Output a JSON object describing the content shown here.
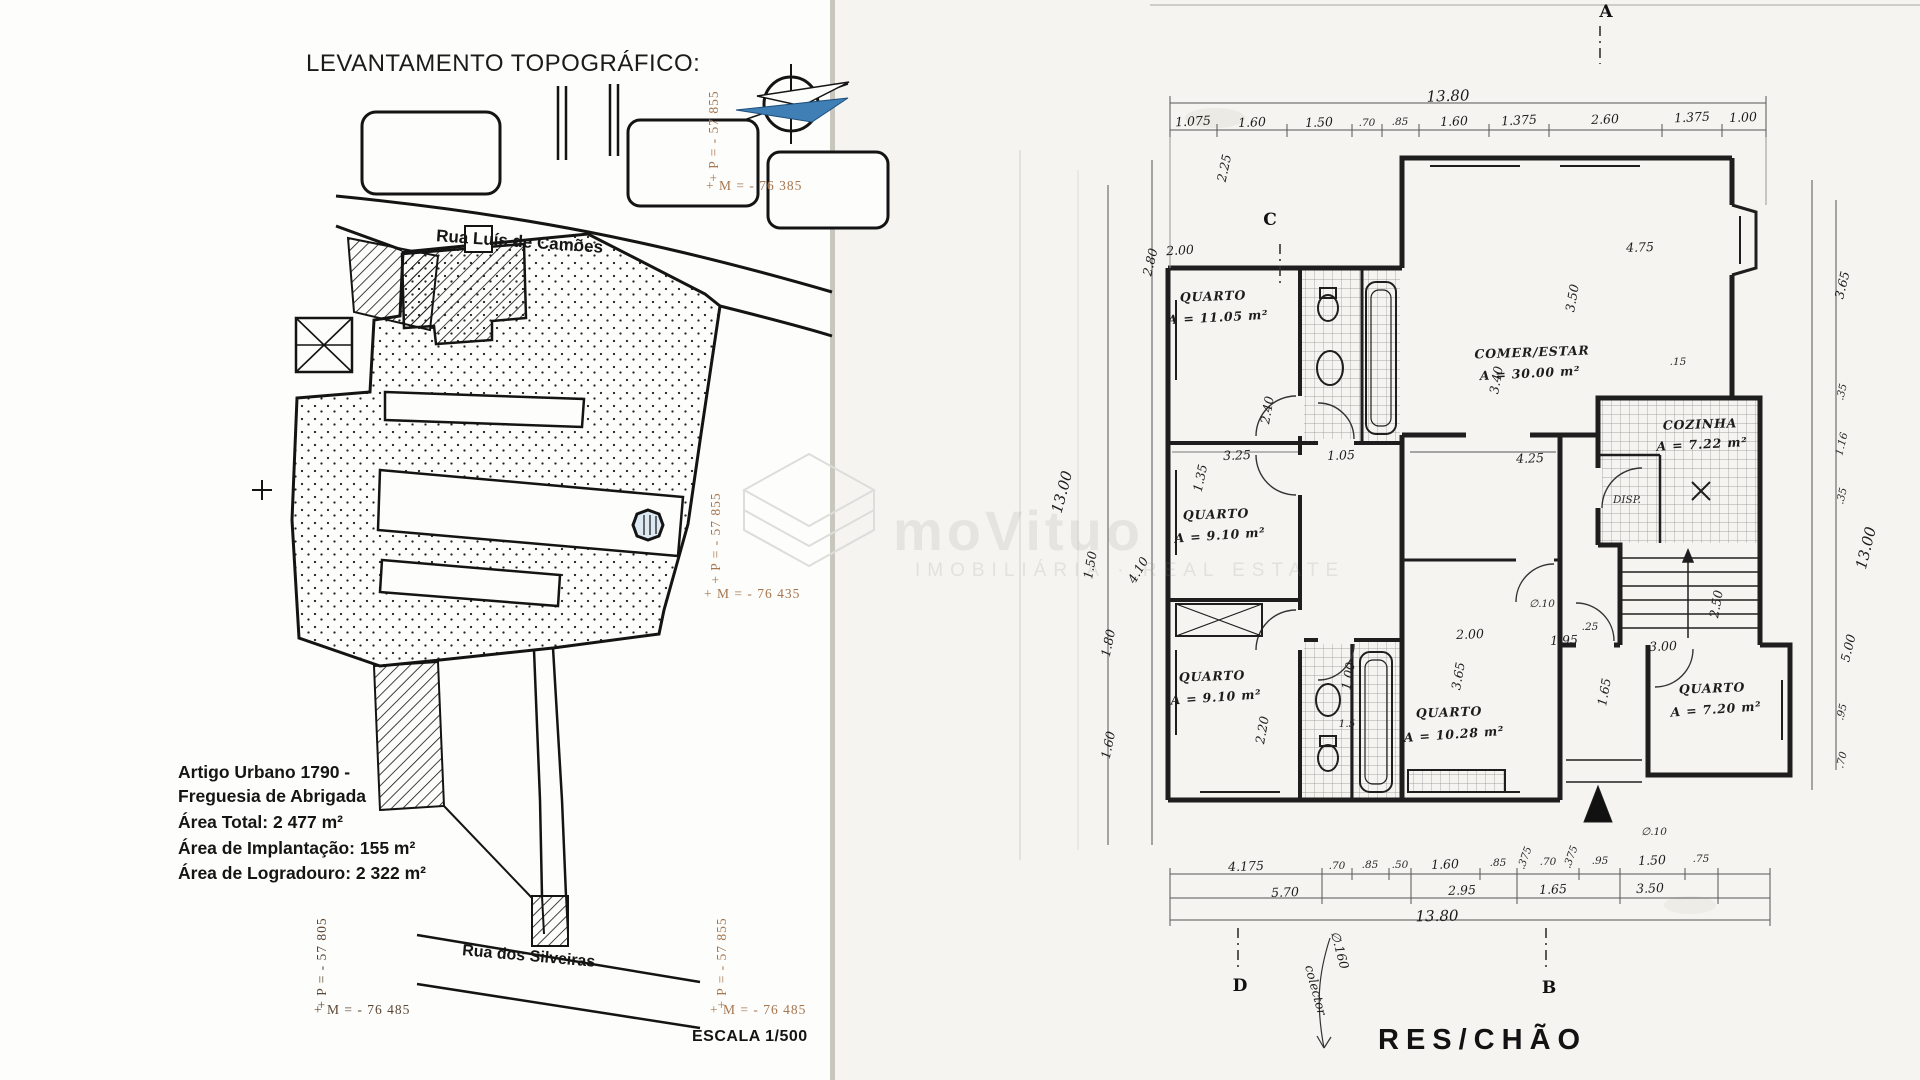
{
  "left_panel": {
    "title": "LEVANTAMENTO TOPOGRÁFICO:",
    "street_top": "Rua Luís de Camões",
    "street_bottom": "Rua dos Silveiras",
    "info": {
      "artigo_line1": "Artigo Urbano 1790 -",
      "artigo_line2": "Freguesia de Abrigada",
      "area_total": "Área Total: 2 477 m²",
      "area_implantacao": "Área de Implantação: 155 m²",
      "area_logradouro": "Área de Logradouro: 2 322 m²"
    },
    "scale": "ESCALA 1/500",
    "coords": {
      "top_right_p": "+ P = - 57 855",
      "top_right_m": "+ M = - 76 385",
      "mid_right_p": "+ P = - 57 855",
      "mid_right_m": "+ M = - 76 435",
      "bottom_left_p": "+ P = - 57 805",
      "bottom_left_m": "+ M = - 76 485",
      "bottom_right_p": "+ P = - 57 855",
      "bottom_right_m": "+ M = - 76 485"
    }
  },
  "watermark": {
    "brand": "moVituo",
    "subtitle": "IMOBILIÁRIA · REAL ESTATE"
  },
  "floor_plan": {
    "title": "RES/CHÃO",
    "markers": [
      {
        "label": "A",
        "x": 1606,
        "y": 12
      },
      {
        "label": "B",
        "x": 1549,
        "y": 988
      },
      {
        "label": "C",
        "x": 1270,
        "y": 220
      },
      {
        "label": "D",
        "x": 1240,
        "y": 986
      }
    ],
    "rooms": [
      {
        "name": "QUARTO",
        "area_m2": "11.05"
      },
      {
        "name": "QUARTO",
        "area_m2": "9.10"
      },
      {
        "name": "QUARTO",
        "area_m2": "9.10"
      },
      {
        "name": "QUARTO",
        "area_m2": "10.28"
      },
      {
        "name": "QUARTO",
        "area_m2": "7.20"
      },
      {
        "name": "COMER/ESTAR",
        "area_m2": "30.00"
      },
      {
        "name": "COZINHA",
        "area_m2": "7.22"
      },
      {
        "name": "DISP.",
        "area_m2": ""
      }
    ],
    "dimensions": {
      "top_total": "13.80",
      "top_segments": [
        "1.075",
        "1.60",
        "1.50",
        ".70",
        ".85",
        "1.60",
        "1.375",
        "2.60",
        "1.375",
        "1.00"
      ],
      "bottom_row1": [
        "4.175",
        ".70",
        ".85",
        ".50",
        "1.60",
        ".85",
        ".375",
        ".70",
        ".375",
        ".95",
        "1.50",
        ".75"
      ],
      "bottom_row2": [
        "5.70",
        "2.95",
        "1.65",
        "3.50"
      ],
      "bottom_total": "13.80",
      "left_side": [
        "2.25",
        "2.80",
        "1.35",
        "13.00",
        "1.50",
        "4.10",
        "1.80",
        "1.60"
      ],
      "right_side": [
        "3.65",
        ".35",
        "1.16",
        ".35",
        "13.00",
        "5.00",
        ".95",
        ".70"
      ],
      "note": "colector ∅.160"
    },
    "labels": [
      {
        "t": "13.80",
        "x": 1448,
        "y": 96,
        "r": -2,
        "c": "hw-lg"
      },
      {
        "t": "1.075",
        "x": 1193,
        "y": 121,
        "r": -3,
        "c": "hw"
      },
      {
        "t": "1.60",
        "x": 1252,
        "y": 122,
        "r": -2,
        "c": "hw"
      },
      {
        "t": "1.50",
        "x": 1319,
        "y": 122,
        "r": -2,
        "c": "hw"
      },
      {
        "t": ".70",
        "x": 1367,
        "y": 123,
        "r": 0,
        "c": "small"
      },
      {
        "t": ".85",
        "x": 1400,
        "y": 122,
        "r": 0,
        "c": "small"
      },
      {
        "t": "1.60",
        "x": 1454,
        "y": 121,
        "r": -2,
        "c": "hw"
      },
      {
        "t": "1.375",
        "x": 1519,
        "y": 120,
        "r": -3,
        "c": "hw"
      },
      {
        "t": "2.60",
        "x": 1605,
        "y": 119,
        "r": -2,
        "c": "hw"
      },
      {
        "t": "1.375",
        "x": 1692,
        "y": 117,
        "r": -3,
        "c": "hw"
      },
      {
        "t": "1.00",
        "x": 1743,
        "y": 117,
        "r": -2,
        "c": "hw"
      },
      {
        "t": "2.25",
        "x": 1224,
        "y": 168,
        "r": -78,
        "c": "hw"
      },
      {
        "t": "2.00",
        "x": 1180,
        "y": 250,
        "r": -3,
        "c": "hw"
      },
      {
        "t": "2.80",
        "x": 1150,
        "y": 262,
        "r": -76,
        "c": "hw"
      },
      {
        "t": "1.35",
        "x": 1200,
        "y": 478,
        "r": -78,
        "c": "hw"
      },
      {
        "t": "13.00",
        "x": 1062,
        "y": 492,
        "r": -75,
        "c": "hw-lg"
      },
      {
        "t": "1.50",
        "x": 1090,
        "y": 565,
        "r": -80,
        "c": "hw"
      },
      {
        "t": "4.10",
        "x": 1138,
        "y": 570,
        "r": -60,
        "c": "hw"
      },
      {
        "t": "1.80",
        "x": 1108,
        "y": 643,
        "r": -78,
        "c": "hw"
      },
      {
        "t": "1.60",
        "x": 1108,
        "y": 745,
        "r": -78,
        "c": "hw"
      },
      {
        "t": "QUARTO",
        "x": 1213,
        "y": 296,
        "r": -2,
        "c": "room"
      },
      {
        "t": "A = 11.05 m²",
        "x": 1218,
        "y": 317,
        "r": -3,
        "c": "room"
      },
      {
        "t": "QUARTO",
        "x": 1216,
        "y": 514,
        "r": -2,
        "c": "room"
      },
      {
        "t": "A = 9.10 m²",
        "x": 1220,
        "y": 535,
        "r": -4,
        "c": "room"
      },
      {
        "t": "QUARTO",
        "x": 1212,
        "y": 676,
        "r": -2,
        "c": "room"
      },
      {
        "t": "A = 9.10 m²",
        "x": 1216,
        "y": 697,
        "r": -4,
        "c": "room"
      },
      {
        "t": "QUARTO",
        "x": 1449,
        "y": 712,
        "r": -2,
        "c": "room"
      },
      {
        "t": "A = 10.28 m²",
        "x": 1454,
        "y": 734,
        "r": -4,
        "c": "room"
      },
      {
        "t": "QUARTO",
        "x": 1712,
        "y": 688,
        "r": -2,
        "c": "room"
      },
      {
        "t": "A = 7.20 m²",
        "x": 1716,
        "y": 709,
        "r": -4,
        "c": "room"
      },
      {
        "t": "COMER/ESTAR",
        "x": 1532,
        "y": 352,
        "r": -2,
        "c": "room"
      },
      {
        "t": "A = 30.00 m²",
        "x": 1530,
        "y": 373,
        "r": -3,
        "c": "room"
      },
      {
        "t": "COZINHA",
        "x": 1700,
        "y": 424,
        "r": -2,
        "c": "room"
      },
      {
        "t": "A = 7.22 m²",
        "x": 1702,
        "y": 444,
        "r": -3,
        "c": "room"
      },
      {
        "t": "DISP.",
        "x": 1627,
        "y": 500,
        "r": 0,
        "c": "small"
      },
      {
        "t": "4.75",
        "x": 1640,
        "y": 247,
        "r": -2,
        "c": "hw"
      },
      {
        "t": "3.50",
        "x": 1572,
        "y": 298,
        "r": -80,
        "c": "hw"
      },
      {
        "t": ".15",
        "x": 1678,
        "y": 362,
        "r": 0,
        "c": "small"
      },
      {
        "t": "3.40",
        "x": 1496,
        "y": 380,
        "r": -80,
        "c": "hw"
      },
      {
        "t": "2.40",
        "x": 1267,
        "y": 410,
        "r": -80,
        "c": "hw"
      },
      {
        "t": "3.25",
        "x": 1237,
        "y": 455,
        "r": -2,
        "c": "hw"
      },
      {
        "t": "1.05",
        "x": 1341,
        "y": 455,
        "r": -2,
        "c": "hw"
      },
      {
        "t": "4.25",
        "x": 1530,
        "y": 458,
        "r": -2,
        "c": "hw"
      },
      {
        "t": "1.00",
        "x": 1348,
        "y": 676,
        "r": -80,
        "c": "hw"
      },
      {
        "t": "2.00",
        "x": 1470,
        "y": 634,
        "r": -2,
        "c": "hw"
      },
      {
        "t": "1.95",
        "x": 1564,
        "y": 640,
        "r": -2,
        "c": "hw"
      },
      {
        "t": "3.00",
        "x": 1663,
        "y": 646,
        "r": -2,
        "c": "hw"
      },
      {
        "t": "2.50",
        "x": 1716,
        "y": 604,
        "r": -80,
        "c": "hw"
      },
      {
        "t": "3.65",
        "x": 1458,
        "y": 676,
        "r": -80,
        "c": "hw"
      },
      {
        "t": "2.20",
        "x": 1262,
        "y": 730,
        "r": -80,
        "c": "hw"
      },
      {
        "t": "1.65",
        "x": 1604,
        "y": 692,
        "r": -80,
        "c": "hw"
      },
      {
        "t": "1.5",
        "x": 1347,
        "y": 724,
        "r": 0,
        "c": "small"
      },
      {
        "t": "∅.10",
        "x": 1542,
        "y": 604,
        "r": 0,
        "c": "small"
      },
      {
        "t": "∅.10",
        "x": 1654,
        "y": 832,
        "r": 0,
        "c": "small"
      },
      {
        "t": ".25",
        "x": 1590,
        "y": 627,
        "r": 0,
        "c": "small"
      },
      {
        "t": "3.65",
        "x": 1842,
        "y": 285,
        "r": -76,
        "c": "hw"
      },
      {
        "t": ".35",
        "x": 1842,
        "y": 392,
        "r": -76,
        "c": "small"
      },
      {
        "t": "1.16",
        "x": 1842,
        "y": 444,
        "r": -76,
        "c": "small"
      },
      {
        "t": ".35",
        "x": 1842,
        "y": 496,
        "r": -76,
        "c": "small"
      },
      {
        "t": "13.00",
        "x": 1866,
        "y": 548,
        "r": -76,
        "c": "hw-lg"
      },
      {
        "t": "5.00",
        "x": 1848,
        "y": 648,
        "r": -76,
        "c": "hw"
      },
      {
        "t": ".95",
        "x": 1842,
        "y": 712,
        "r": -76,
        "c": "small"
      },
      {
        "t": ".70",
        "x": 1842,
        "y": 760,
        "r": -76,
        "c": "small"
      },
      {
        "t": "4.175",
        "x": 1246,
        "y": 866,
        "r": -2,
        "c": "hw"
      },
      {
        "t": ".70",
        "x": 1337,
        "y": 866,
        "r": 0,
        "c": "small"
      },
      {
        "t": ".85",
        "x": 1370,
        "y": 865,
        "r": 0,
        "c": "small"
      },
      {
        "t": ".50",
        "x": 1400,
        "y": 865,
        "r": 0,
        "c": "small"
      },
      {
        "t": "1.60",
        "x": 1445,
        "y": 864,
        "r": -2,
        "c": "hw"
      },
      {
        "t": ".85",
        "x": 1498,
        "y": 863,
        "r": 0,
        "c": "small"
      },
      {
        "t": ".375",
        "x": 1525,
        "y": 858,
        "r": -70,
        "c": "small"
      },
      {
        "t": ".70",
        "x": 1548,
        "y": 862,
        "r": 0,
        "c": "small"
      },
      {
        "t": ".375",
        "x": 1571,
        "y": 857,
        "r": -70,
        "c": "small"
      },
      {
        "t": ".95",
        "x": 1600,
        "y": 861,
        "r": 0,
        "c": "small"
      },
      {
        "t": "1.50",
        "x": 1652,
        "y": 860,
        "r": -2,
        "c": "hw"
      },
      {
        "t": ".75",
        "x": 1701,
        "y": 859,
        "r": 0,
        "c": "small"
      },
      {
        "t": "5.70",
        "x": 1285,
        "y": 892,
        "r": -2,
        "c": "hw"
      },
      {
        "t": "2.95",
        "x": 1462,
        "y": 890,
        "r": -2,
        "c": "hw"
      },
      {
        "t": "1.65",
        "x": 1553,
        "y": 889,
        "r": -2,
        "c": "hw"
      },
      {
        "t": "3.50",
        "x": 1650,
        "y": 888,
        "r": -2,
        "c": "hw"
      },
      {
        "t": "13.80",
        "x": 1437,
        "y": 916,
        "r": -1,
        "c": "hw-lg"
      },
      {
        "t": "colector",
        "x": 1316,
        "y": 990,
        "r": 75,
        "c": "hw"
      },
      {
        "t": "∅.160",
        "x": 1340,
        "y": 950,
        "r": 75,
        "c": "hw"
      }
    ]
  }
}
